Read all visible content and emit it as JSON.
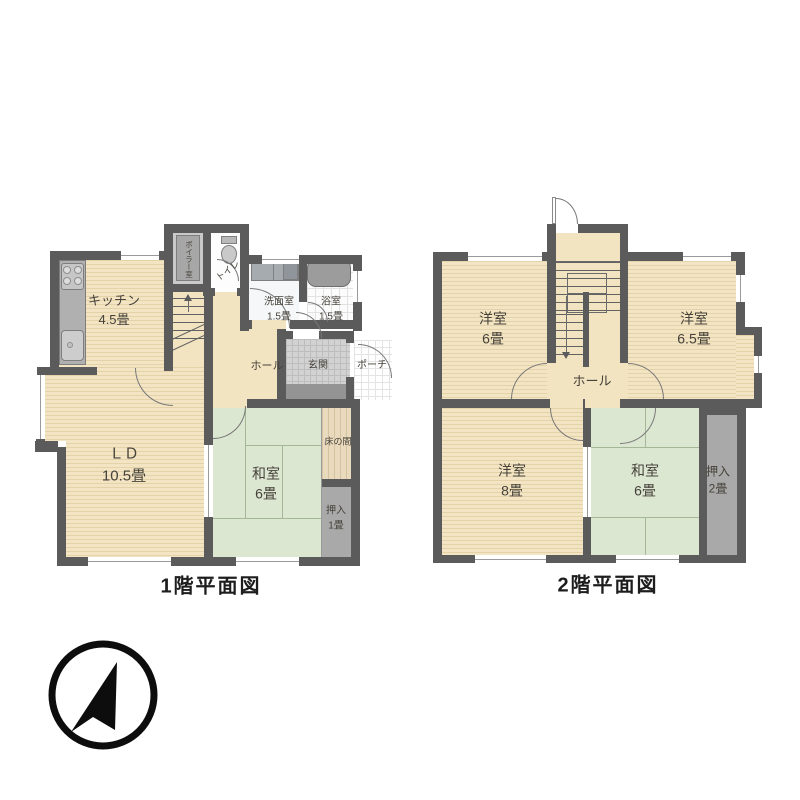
{
  "document": {
    "background": "#ffffff",
    "type": "japanese-floor-plan"
  },
  "palette": {
    "wall": "#5b5b5b",
    "wood_floor": "#f3e5c4",
    "tatami_floor": "#dce7d2",
    "closet_floor": "#a9a9a9",
    "tokonoma_floor": "#e9dabd",
    "entrance_tile": "#d2d2d2",
    "fixture_gray": "#b3b3b3",
    "compass_black": "#0d0d0d"
  },
  "floor1": {
    "title": "1階平面図",
    "rooms": {
      "kitchen": {
        "name": "キッチン",
        "size": "4.5畳"
      },
      "living_dining": {
        "name": "ＬＤ",
        "size": "10.5畳"
      },
      "washitsu": {
        "name": "和室",
        "size": "6畳"
      },
      "oshiire": {
        "name": "押入",
        "size": "1畳"
      },
      "tokonoma": {
        "name": "床の間"
      },
      "toilet": {
        "name": "トイレ"
      },
      "boiler": {
        "name": "ボイラー室"
      },
      "washroom": {
        "name": "洗面室",
        "size": "1.5畳"
      },
      "bathroom": {
        "name": "浴室",
        "size": "1.5畳"
      },
      "hall": {
        "name": "ホール"
      },
      "genkan": {
        "name": "玄関"
      },
      "porch": {
        "name": "ポーチ"
      }
    }
  },
  "floor2": {
    "title": "2階平面図",
    "rooms": {
      "yoshitsu_6": {
        "name": "洋室",
        "size": "6畳"
      },
      "yoshitsu_65": {
        "name": "洋室",
        "size": "6.5畳"
      },
      "yoshitsu_8": {
        "name": "洋室",
        "size": "8畳"
      },
      "washitsu": {
        "name": "和室",
        "size": "6畳"
      },
      "oshiire": {
        "name": "押入",
        "size": "2畳"
      },
      "hall": {
        "name": "ホール"
      }
    }
  },
  "compass": {
    "icon": "north-arrow-icon"
  }
}
